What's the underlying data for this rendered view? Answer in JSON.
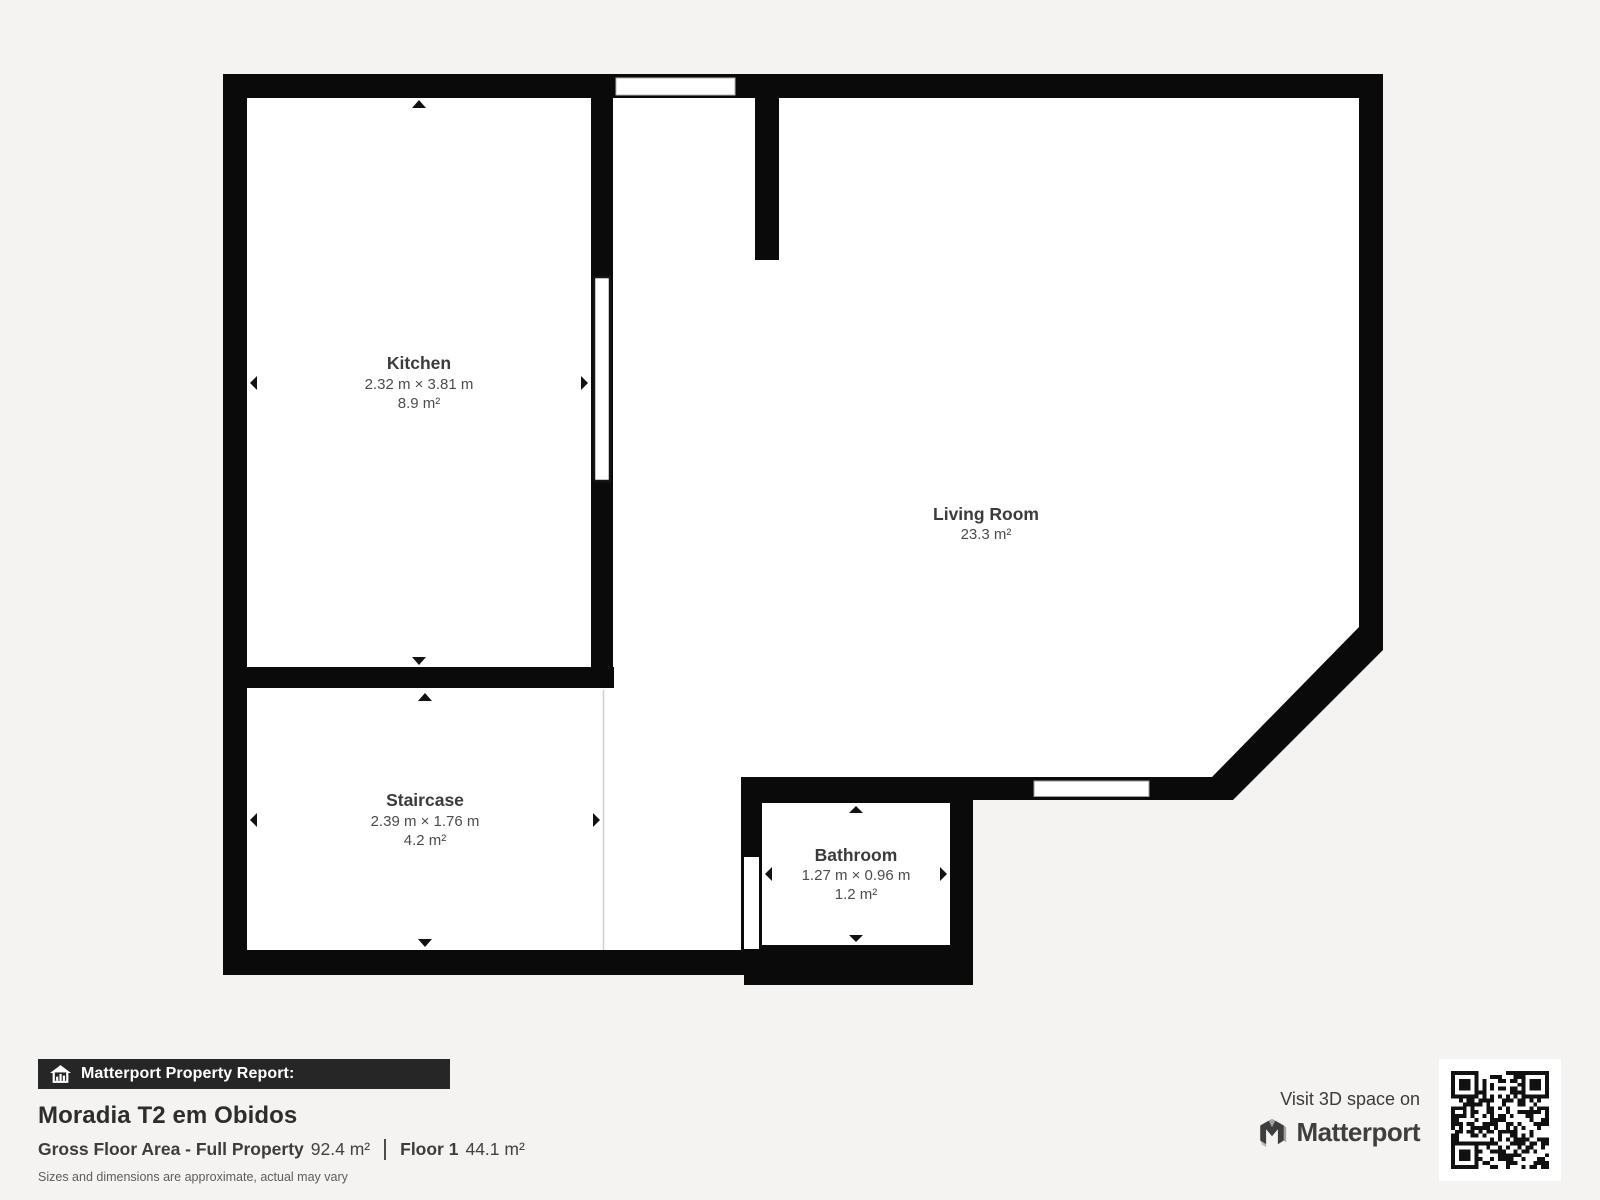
{
  "floor_plan": {
    "rooms": {
      "kitchen": {
        "name": "Kitchen",
        "dimensions": "2.32 m × 3.81 m",
        "area": "8.9 m²"
      },
      "living_room": {
        "name": "Living Room",
        "dimensions": "",
        "area": "23.3 m²"
      },
      "staircase": {
        "name": "Staircase",
        "dimensions": "2.39 m × 1.76 m",
        "area": "4.2 m²"
      },
      "bathroom": {
        "name": "Bathroom",
        "dimensions": "1.27 m × 0.96 m",
        "area": "1.2 m²"
      }
    },
    "icons": {
      "dimension_arrows": "triangle-arrow-icon"
    },
    "colors": {
      "wall": "#0a0a0a",
      "interior": "#ffffff",
      "background": "#f4f3f1"
    }
  },
  "footer": {
    "report_banner_label": "Matterport Property Report:",
    "property_title": "Moradia T2 em Obidos",
    "gross_floor_area_label": "Gross Floor Area - Full Property",
    "gross_floor_area_value": "92.4 m²",
    "floor_label": "Floor 1",
    "floor_value": "44.1 m²",
    "disclaimer": "Sizes and dimensions are approximate, actual may vary",
    "visit_text": "Visit 3D space on",
    "brand_name": "Matterport",
    "icons": {
      "banner_icon": "house-chart-icon",
      "brand_icon": "matterport-m-icon",
      "qr": "qr-code"
    },
    "colors": {
      "banner_background": "#262626",
      "banner_text": "#ffffff",
      "text_dark": "#2d2d2d"
    }
  }
}
